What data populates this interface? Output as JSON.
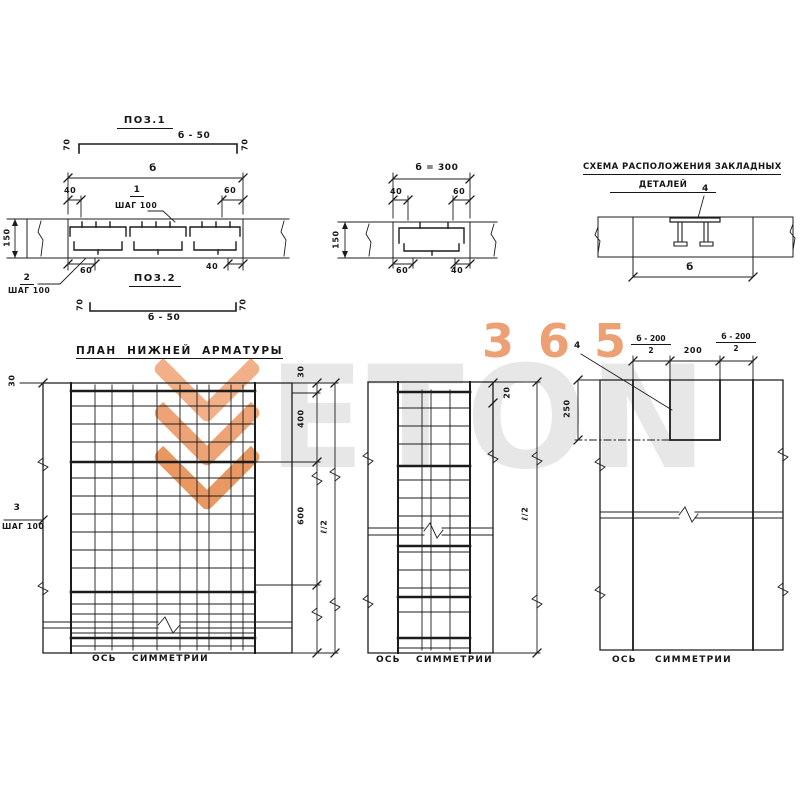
{
  "watermark": {
    "brand": "ETON",
    "number": "365",
    "orange": "#ec9b6d",
    "gray": "#e7e7e7"
  },
  "pos1": {
    "title": "ПОЗ.1",
    "length": "б - 50",
    "end_dim": "70"
  },
  "section1": {
    "overall": "б",
    "top_left": "40",
    "top_right": "60",
    "callout_top_num": "1",
    "callout_top_step": "ШАГ 100",
    "height": "150",
    "bottom_left": "60",
    "bottom_right": "40",
    "callout_bottom_num": "2",
    "callout_bottom_step": "ШАГ 100"
  },
  "pos2": {
    "title": "ПОЗ.2",
    "length": "б - 50",
    "end_dim": "70"
  },
  "section2": {
    "overall": "б = 300",
    "top_left": "40",
    "top_right": "60",
    "height": "150",
    "bottom_left": "60",
    "bottom_right": "40"
  },
  "scheme": {
    "title_line1": "СХЕМА РАСПОЛОЖЕНИЯ ЗАКЛАДНЫХ",
    "title_line2": "ДЕТАЛЕЙ",
    "callout": "4",
    "width": "б"
  },
  "plan_left": {
    "title": "ПЛАН НИЖНЕЙ АРМАТУРЫ",
    "edge_dim_left": "30",
    "callout_num": "3",
    "callout_step": "ШАГ 100",
    "edge_dim_right": "30",
    "dim_400": "400",
    "dim_600": "600",
    "half_length": "ℓ/2",
    "axis": "ОСЬ СИММЕТРИИ"
  },
  "plan_middle": {
    "edge_dim": "20",
    "half_length": "ℓ/2",
    "axis": "ОСЬ СИММЕТРИИ"
  },
  "plan_right": {
    "callout": "4",
    "frac_num": "б - 200",
    "frac_den": "2",
    "center_dim": "200",
    "depth_dim": "250",
    "axis": "ОСЬ СИММЕТРИИ"
  }
}
